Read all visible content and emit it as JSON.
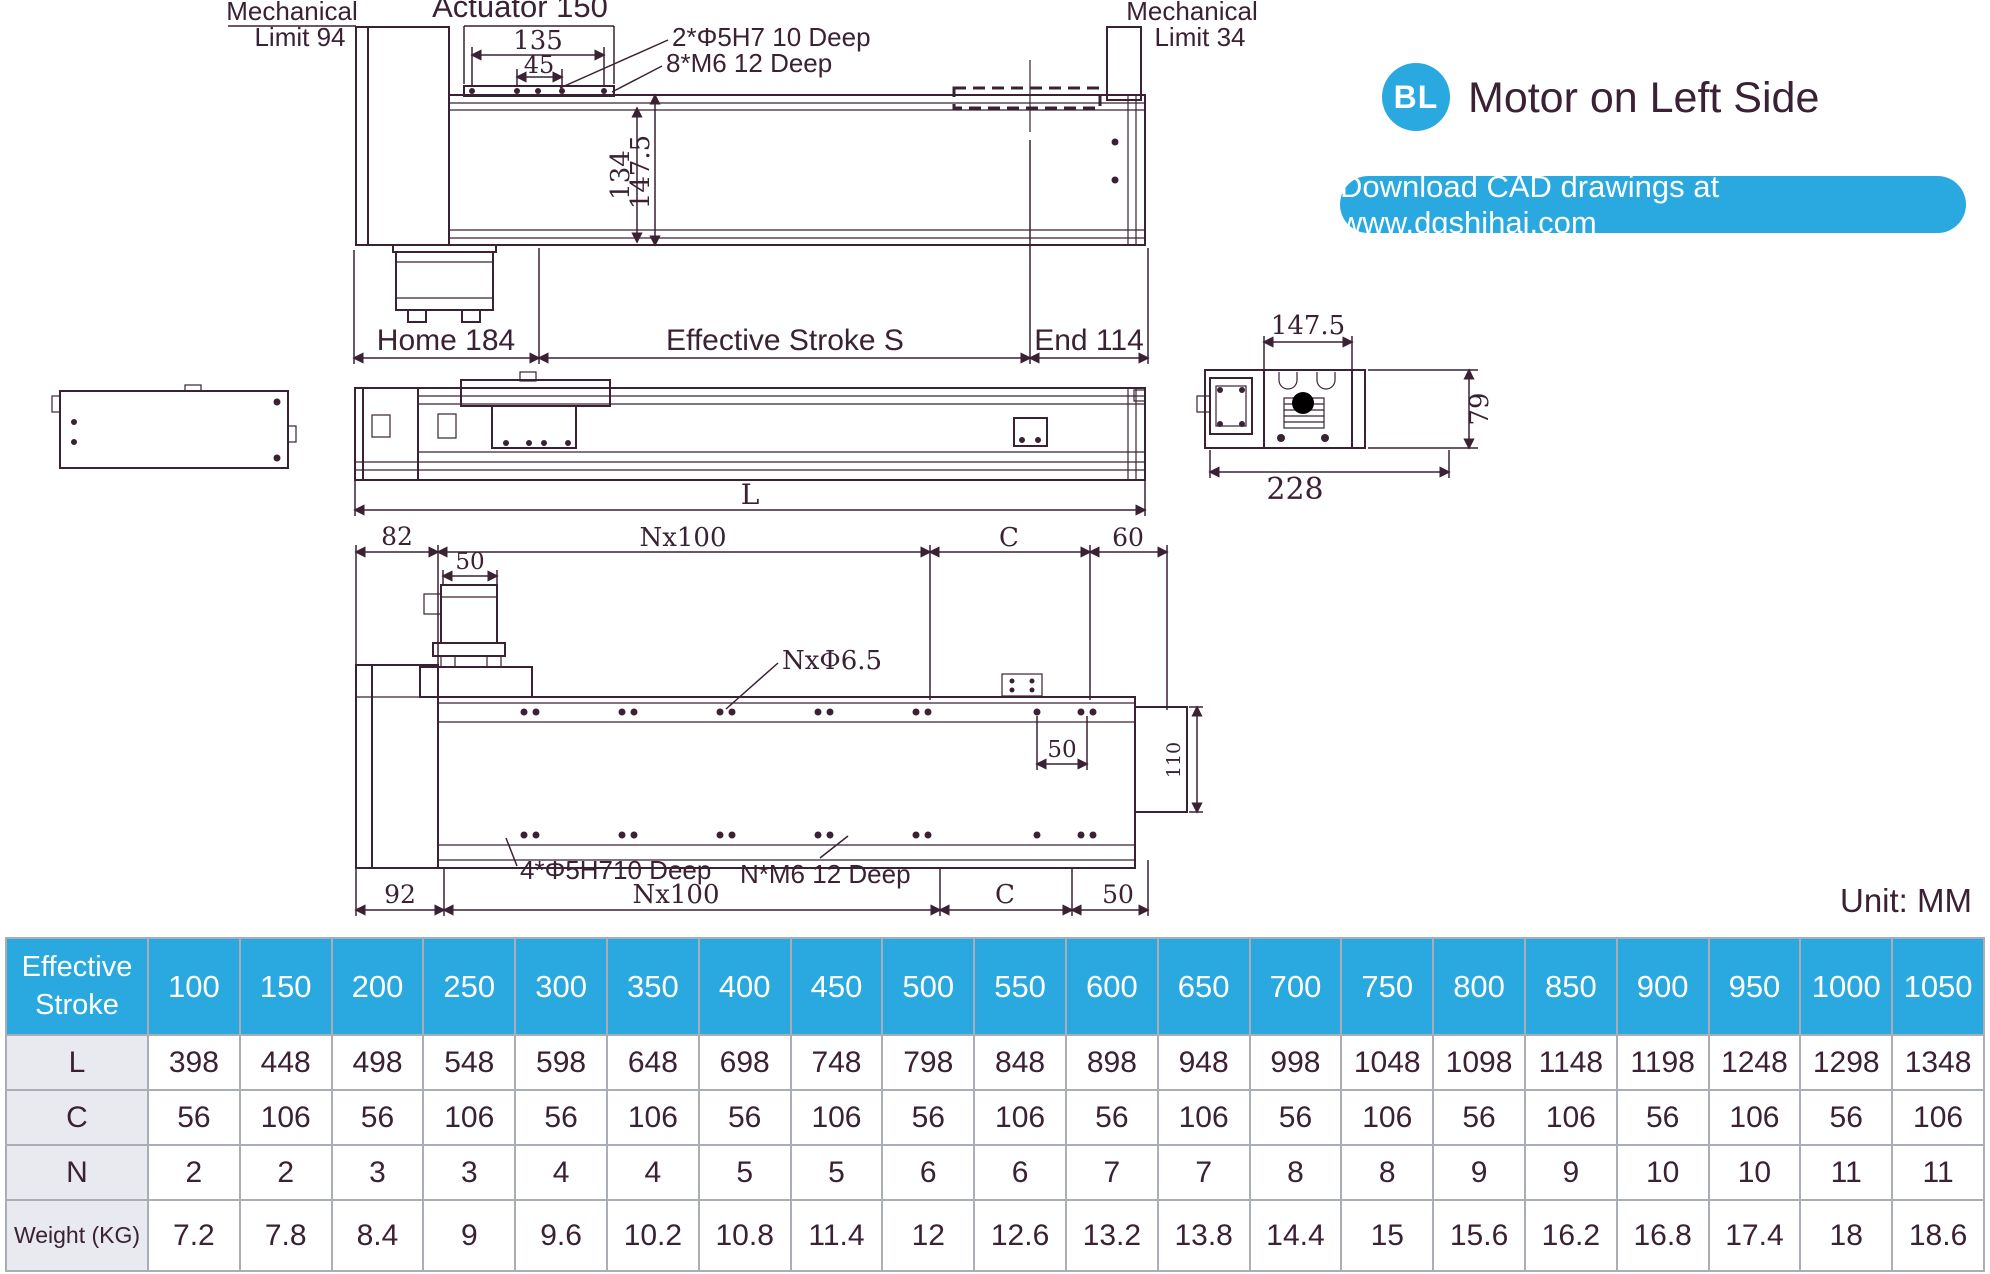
{
  "colors": {
    "accent_blue": "#29a9e0",
    "drawing_line": "#3a2133",
    "table_label_bg": "#e9e9f0",
    "table_border": "#a9aeb6"
  },
  "header": {
    "badge": "BL",
    "title": "Motor on Left Side",
    "banner": "Download CAD drawings at www.dgshihai.com"
  },
  "unit_note": "Unit: MM",
  "front_view": {
    "mech_left1": "Mechanical",
    "mech_left2": "Limit 94",
    "actuator": "Actuator 150",
    "dim_135": "135",
    "dim_45": "45",
    "note_dowel": "2*Φ5H7 10 Deep",
    "note_tap": "8*M6 12 Deep",
    "mech_right1": "Mechanical",
    "mech_right2": "Limit 34",
    "dim_134": "134",
    "dim_147_5": "147.5",
    "home": "Home 184",
    "stroke_s": "Effective Stroke S",
    "end": "End 114"
  },
  "side_view": {
    "dim_L": "L"
  },
  "end_view": {
    "dim_147_5": "147.5",
    "dim_79": "79",
    "dim_228": "228"
  },
  "bottom_view": {
    "dim_82": "82",
    "dim_nx100_top": "Nx100",
    "dim_c_top": "C",
    "dim_60": "60",
    "dim_50_motor": "50",
    "note_holes": "NxΦ6.5",
    "dim_50_pitch": "50",
    "dim_110": "110",
    "note_dowel": "4*Φ5H710 Deep",
    "note_tap": "N*M6 12 Deep",
    "dim_92": "92",
    "dim_nx100_bottom": "Nx100",
    "dim_c_bottom": "C",
    "dim_50_end": "50"
  },
  "table": {
    "header_label": "Effective\nStroke",
    "strokes": [
      "100",
      "150",
      "200",
      "250",
      "300",
      "350",
      "400",
      "450",
      "500",
      "550",
      "600",
      "650",
      "700",
      "750",
      "800",
      "850",
      "900",
      "950",
      "1000",
      "1050"
    ],
    "rows": [
      {
        "label": "L",
        "values": [
          "398",
          "448",
          "498",
          "548",
          "598",
          "648",
          "698",
          "748",
          "798",
          "848",
          "898",
          "948",
          "998",
          "1048",
          "1098",
          "1148",
          "1198",
          "1248",
          "1298",
          "1348"
        ]
      },
      {
        "label": "C",
        "values": [
          "56",
          "106",
          "56",
          "106",
          "56",
          "106",
          "56",
          "106",
          "56",
          "106",
          "56",
          "106",
          "56",
          "106",
          "56",
          "106",
          "56",
          "106",
          "56",
          "106"
        ]
      },
      {
        "label": "N",
        "values": [
          "2",
          "2",
          "3",
          "3",
          "4",
          "4",
          "5",
          "5",
          "6",
          "6",
          "7",
          "7",
          "8",
          "8",
          "9",
          "9",
          "10",
          "10",
          "11",
          "11"
        ]
      },
      {
        "label": "Weight (KG)",
        "values": [
          "7.2",
          "7.8",
          "8.4",
          "9",
          "9.6",
          "10.2",
          "10.8",
          "11.4",
          "12",
          "12.6",
          "13.2",
          "13.8",
          "14.4",
          "15",
          "15.6",
          "16.2",
          "16.8",
          "17.4",
          "18",
          "18.6"
        ]
      }
    ]
  }
}
